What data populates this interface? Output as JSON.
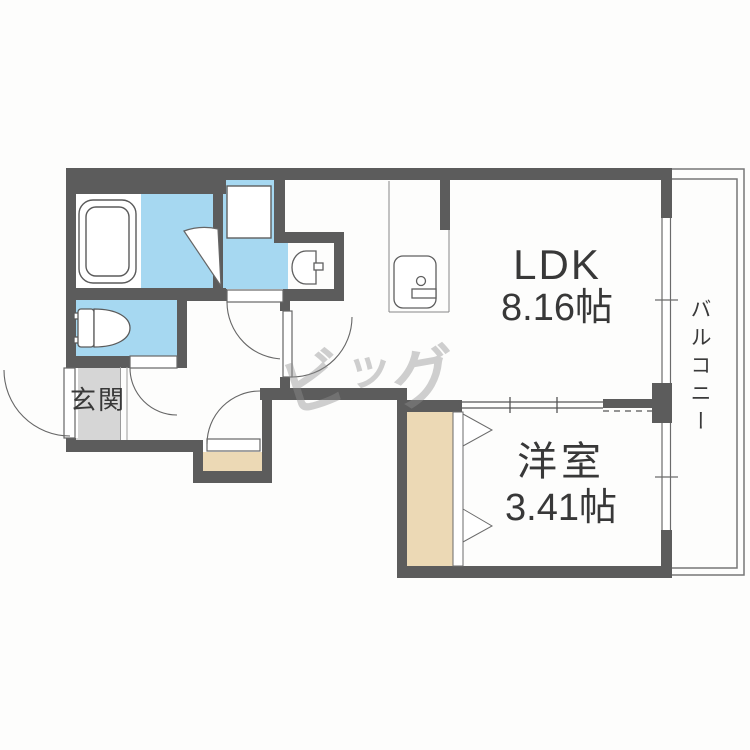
{
  "document": {
    "type": "apartment-floor-plan",
    "layout_name": "1LDK"
  },
  "rooms": {
    "ldk": {
      "name": "LDK",
      "size": "8.16帖"
    },
    "western_room": {
      "name": "洋室",
      "size": "3.41帖"
    },
    "entrance": {
      "name": "玄関"
    },
    "balcony": {
      "name": "バルコニー"
    }
  },
  "watermark": {
    "text": "ビッグ",
    "char1": "ビ",
    "char2": "ッ",
    "char3": "グ"
  },
  "fixtures": [
    "bathtub-icon",
    "bathroom-folding-door-icon",
    "washing-machine-pan-icon",
    "washbasin-icon",
    "toilet-icon",
    "kitchen-sink-icon",
    "closet-bifold-door-icon",
    "sliding-partition-icon",
    "window-icon",
    "hinged-door-icon"
  ],
  "colors": {
    "wall": "#5c5c5c",
    "wet_area_blue": "#a6d8f1",
    "wood_beige": "#ecd9b5",
    "entrance_gray": "#d6d6d6",
    "outline_gray": "#6b6b6b",
    "text": "#383838",
    "watermark_gray": "#8f8f8f"
  }
}
